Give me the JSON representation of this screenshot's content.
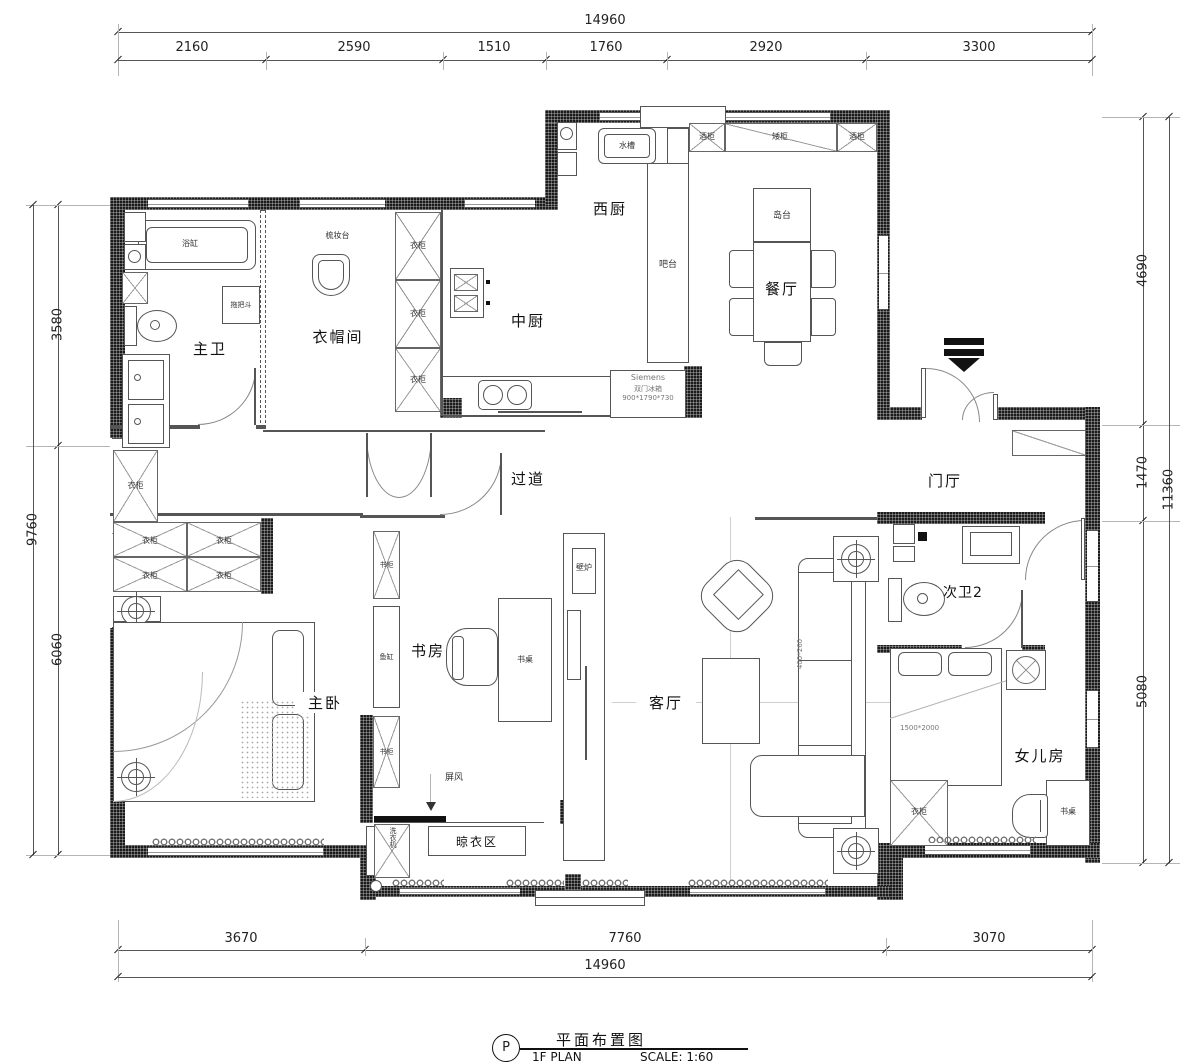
{
  "title": {
    "mark": "P",
    "cn": "平面布置图",
    "en": "1F PLAN",
    "scale": "SCALE: 1:60"
  },
  "dims": {
    "top": {
      "total": "14960",
      "segments": [
        "2160",
        "2590",
        "1510",
        "1760",
        "2920",
        "3300"
      ]
    },
    "bottom": {
      "segments": [
        "3670",
        "7760",
        "3070"
      ],
      "total": "14960"
    },
    "left": {
      "total": "9760",
      "segments": [
        "3580",
        "6060"
      ]
    },
    "right": {
      "segments": [
        "4690",
        "1470",
        "5080"
      ],
      "total": "11360"
    }
  },
  "rooms": {
    "west_kitchen": "西厨",
    "chinese_kitchen": "中厨",
    "dining": "餐厅",
    "master_bath": "主卫",
    "cloakroom": "衣帽间",
    "corridor": "过道",
    "foyer": "门厅",
    "study": "书房",
    "master_bedroom": "主卧",
    "living": "客厅",
    "bath2": "次卫2",
    "daughter": "女儿房",
    "drying": "晾衣区"
  },
  "furn": {
    "sink": "水槽",
    "wine_cabinet": "酒柜",
    "low_cabinet": "矮柜",
    "bar": "吧台",
    "island": "岛台",
    "bathtub": "浴缸",
    "mop": "拖把斗",
    "dresser": "梳妆台",
    "wardrobe": "衣柜",
    "bookcase": "书柜",
    "fish_tank": "鱼缸",
    "desk": "书桌",
    "fireplace": "壁炉",
    "screen": "屏风",
    "washer": "洗衣机",
    "sofa_size": "400*260",
    "bed_size": "1500*2000",
    "fridge_brand": "Siemens",
    "fridge_type": "双门冰箱",
    "fridge_size": "900*1790*730"
  }
}
